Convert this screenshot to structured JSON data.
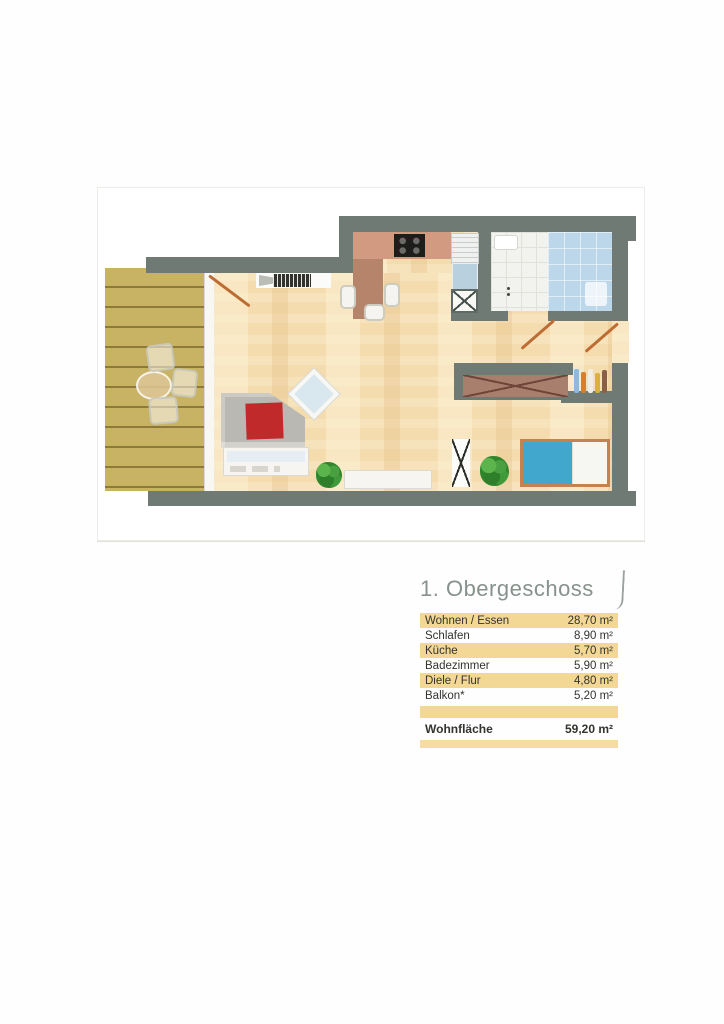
{
  "legend": {
    "title": "1. Obergeschoss",
    "rows": [
      {
        "label": "Wohnen / Essen",
        "value": "28,70 m²",
        "highlight": true
      },
      {
        "label": "Schlafen",
        "value": "8,90 m²",
        "highlight": false
      },
      {
        "label": "Küche",
        "value": "5,70 m²",
        "highlight": true
      },
      {
        "label": "Badezimmer",
        "value": "5,90 m²",
        "highlight": false
      },
      {
        "label": "Diele / Flur",
        "value": "4,80 m²",
        "highlight": true
      },
      {
        "label": "Balkon*",
        "value": "5,20 m²",
        "highlight": false
      }
    ],
    "total": {
      "label": "Wohnfläche",
      "value": "59,20 m²"
    }
  },
  "colors": {
    "highlight_band": "#f2d894",
    "title_gray": "#87928c",
    "wall_gray": "#6f7a75",
    "parquet": "#f4dcae",
    "balcony_deck": "#c8b264",
    "kitchen_counter": "#d29a80",
    "bath_tile_blue": "#bcd7e9",
    "bed_blue": "#42a7cd",
    "cushion_red": "#c02a2b",
    "door_swing_orange": "#bd6c34",
    "plant_green": "#3f9a39",
    "wardrobe_brown": "#a87e6d"
  },
  "floorplan": {
    "furniture_icons": [
      "terrace-table",
      "terrace-chair",
      "sofa",
      "red-cushion",
      "coffee-table",
      "lowboard",
      "tv-sideboard",
      "house-plant",
      "dining-table",
      "dining-chair",
      "cooktop",
      "kitchen-counter",
      "kitchen-sink",
      "dishwasher",
      "utility-shaft",
      "washbasin",
      "shower",
      "bed",
      "built-in-wardrobe",
      "coat-niche",
      "clothes-rack",
      "radiator",
      "door-swing"
    ]
  }
}
